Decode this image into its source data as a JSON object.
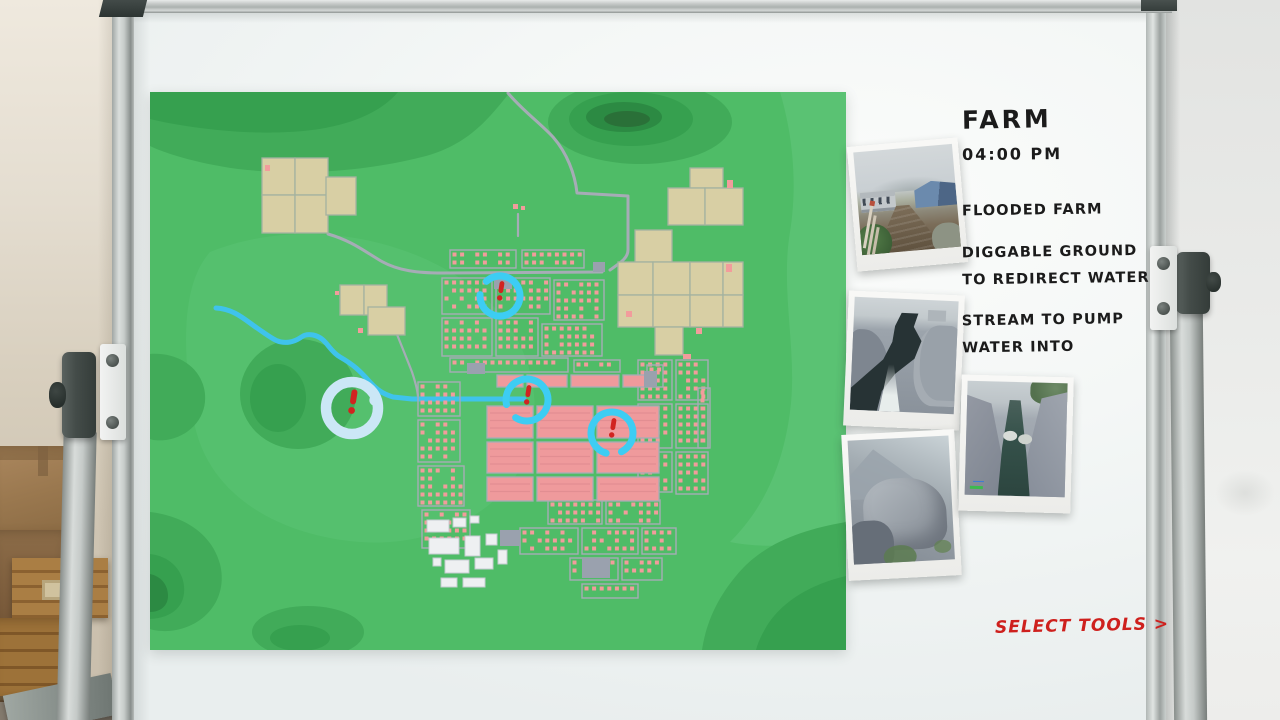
{
  "scene": {
    "name": "Mission planning whiteboard"
  },
  "notes": {
    "title": "FARM",
    "time": "04:00 PM",
    "lines": [
      "FLOODED FARM",
      "DIGGABLE GROUND TO REDIRECT WATER",
      "STREAM TO PUMP WATER INTO"
    ]
  },
  "actions": {
    "select_tools_label": "SELECT TOOLS >"
  },
  "map": {
    "markers": [
      {
        "id": "pond-site",
        "kind": "pond",
        "x": 202,
        "y": 316,
        "r": 26
      },
      {
        "id": "north-district-site",
        "kind": "ring",
        "x": 350,
        "y": 204,
        "r": 20
      },
      {
        "id": "canal-site",
        "kind": "ring",
        "x": 377,
        "y": 308,
        "r": 21
      },
      {
        "id": "central-district-site",
        "kind": "ring",
        "x": 462,
        "y": 341,
        "r": 21
      }
    ],
    "colors": {
      "terrain_base": "#4fbc67",
      "terrain_shade1": "#41ab59",
      "terrain_shade2": "#36a04f",
      "terrain_shade3": "#2c8a43",
      "terrain_core": "#2a7038",
      "terrain_light": "#5ac273",
      "terrain_light_center": "#55c06e",
      "field": "#d8cfa4",
      "field_line": "#a3b2a0",
      "road": "#a6acb6",
      "house": "#f29c9c",
      "block": "#ef9a9c",
      "block_stripe": "#e28e92",
      "building_white": "#eef0f2",
      "building_white_line": "#c6cbd1",
      "building_gray": "#9aa1ae",
      "river": "#3fc3ec",
      "marker_ring": "#3dcdf3",
      "marker_pond": "#cbe7f6",
      "alert": "#d12420"
    }
  },
  "photos": [
    {
      "name": "flooded-farm-photo"
    },
    {
      "name": "stream-photo"
    },
    {
      "name": "rocky-hill-photo"
    },
    {
      "name": "canyon-stream-photo"
    }
  ],
  "accent": {
    "handwriting": "#1b1b1b",
    "action_red": "#ce201d"
  }
}
